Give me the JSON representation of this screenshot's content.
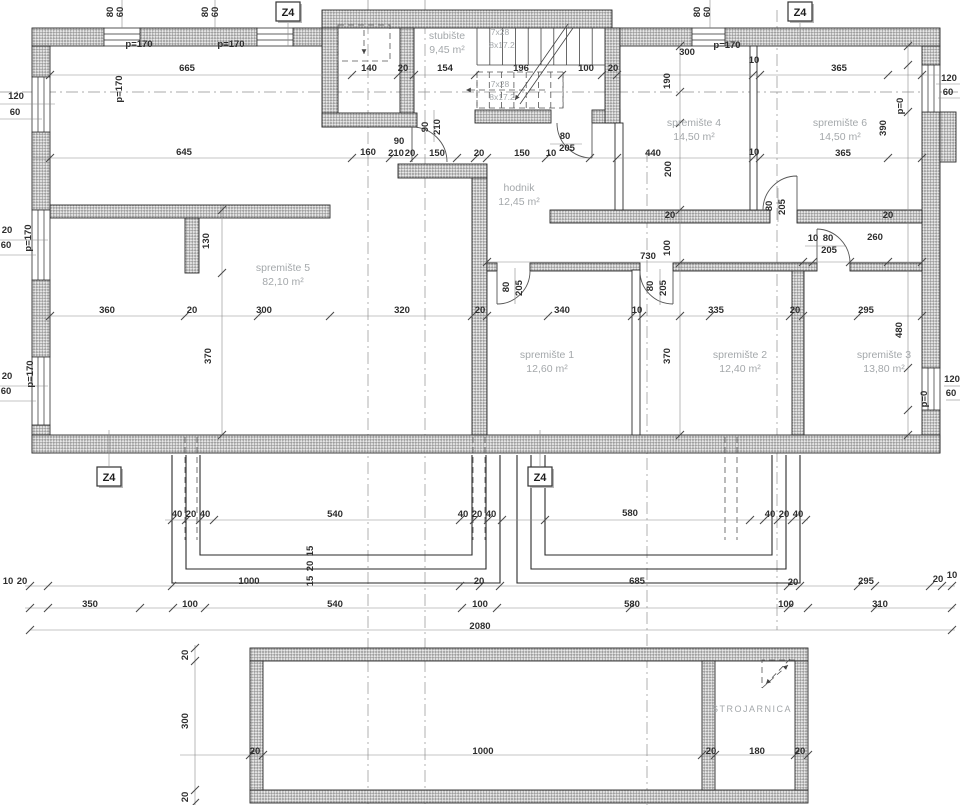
{
  "drawing": {
    "type": "basement floor plan",
    "section_marker_label": "Z4",
    "palette": {
      "line": "#2b2b2b",
      "hatch": "#a6a6a6",
      "dim_text": "#2e2e2e",
      "room_text": "#a4a8ab",
      "background": "#ffffff"
    }
  },
  "rooms": [
    {
      "name": "stubište",
      "area": "9,45 m²",
      "x": 447,
      "y": 39
    },
    {
      "name": "spremište 4",
      "area": "14,50 m²",
      "x": 694,
      "y": 126
    },
    {
      "name": "spremište 6",
      "area": "14,50 m²",
      "x": 840,
      "y": 126
    },
    {
      "name": "hodnik",
      "area": "12,45 m²",
      "x": 519,
      "y": 191
    },
    {
      "name": "spremište 5",
      "area": "82,10 m²",
      "x": 283,
      "y": 271
    },
    {
      "name": "spremište 1",
      "area": "12,60 m²",
      "x": 547,
      "y": 358
    },
    {
      "name": "spremište 2",
      "area": "12,40 m²",
      "x": 740,
      "y": 358
    },
    {
      "name": "spremište 3",
      "area": "13,80 m²",
      "x": 884,
      "y": 358
    },
    {
      "name": "STROJARNICA",
      "area": "",
      "x": 752,
      "y": 712
    }
  ],
  "stair_notes": [
    {
      "t": "7x28",
      "x": 500,
      "y": 35
    },
    {
      "t": "8x17.2",
      "x": 502,
      "y": 48
    },
    {
      "t": "7x28",
      "x": 500,
      "y": 87
    },
    {
      "t": "8x17.2",
      "x": 502,
      "y": 100
    }
  ],
  "section_markers": [
    {
      "x": 288,
      "y": 11
    },
    {
      "x": 800,
      "y": 11
    },
    {
      "x": 109,
      "y": 476
    },
    {
      "x": 540,
      "y": 476
    }
  ],
  "dims": [
    {
      "t": "80",
      "x": 113,
      "y": 12,
      "r": 1
    },
    {
      "t": "60",
      "x": 123,
      "y": 12,
      "r": 1
    },
    {
      "t": "80",
      "x": 208,
      "y": 12,
      "r": 1
    },
    {
      "t": "60",
      "x": 218,
      "y": 12,
      "r": 1
    },
    {
      "t": "80",
      "x": 700,
      "y": 12,
      "r": 1
    },
    {
      "t": "60",
      "x": 710,
      "y": 12,
      "r": 1
    },
    {
      "t": "p=170",
      "x": 139,
      "y": 47
    },
    {
      "t": "p=170",
      "x": 231,
      "y": 47
    },
    {
      "t": "p=170",
      "x": 727,
      "y": 48
    },
    {
      "t": "665",
      "x": 187,
      "y": 71
    },
    {
      "t": "140",
      "x": 369,
      "y": 71
    },
    {
      "t": "20",
      "x": 403,
      "y": 71
    },
    {
      "t": "154",
      "x": 445,
      "y": 71
    },
    {
      "t": "196",
      "x": 521,
      "y": 71
    },
    {
      "t": "100",
      "x": 586,
      "y": 71
    },
    {
      "t": "20",
      "x": 613,
      "y": 71
    },
    {
      "t": "300",
      "x": 687,
      "y": 55
    },
    {
      "t": "10",
      "x": 754,
      "y": 63
    },
    {
      "t": "365",
      "x": 839,
      "y": 71
    },
    {
      "t": "120",
      "x": 949,
      "y": 81
    },
    {
      "t": "60",
      "x": 948,
      "y": 95
    },
    {
      "t": "390",
      "x": 886,
      "y": 128,
      "r": 1
    },
    {
      "t": "p=0",
      "x": 903,
      "y": 106,
      "r": 1
    },
    {
      "t": "190",
      "x": 670,
      "y": 81,
      "r": 1
    },
    {
      "t": "120",
      "x": 16,
      "y": 99
    },
    {
      "t": "60",
      "x": 15,
      "y": 115
    },
    {
      "t": "p=170",
      "x": 122,
      "y": 89,
      "r": 1
    },
    {
      "t": "645",
      "x": 184,
      "y": 155
    },
    {
      "t": "160",
      "x": 368,
      "y": 155
    },
    {
      "t": "90",
      "x": 399,
      "y": 144
    },
    {
      "t": "210",
      "x": 396,
      "y": 156
    },
    {
      "t": "20",
      "x": 410,
      "y": 156
    },
    {
      "t": "90",
      "x": 428,
      "y": 127,
      "r": 1
    },
    {
      "t": "210",
      "x": 440,
      "y": 127,
      "r": 1
    },
    {
      "t": "150",
      "x": 437,
      "y": 156
    },
    {
      "t": "20",
      "x": 479,
      "y": 156
    },
    {
      "t": "150",
      "x": 522,
      "y": 156
    },
    {
      "t": "10",
      "x": 551,
      "y": 156
    },
    {
      "t": "80",
      "x": 565,
      "y": 139
    },
    {
      "t": "205",
      "x": 567,
      "y": 151
    },
    {
      "t": "440",
      "x": 653,
      "y": 156
    },
    {
      "t": "200",
      "x": 671,
      "y": 169,
      "r": 1
    },
    {
      "t": "10",
      "x": 754,
      "y": 155
    },
    {
      "t": "365",
      "x": 843,
      "y": 156
    },
    {
      "t": "p=170",
      "x": 31,
      "y": 238,
      "r": 1
    },
    {
      "t": "20",
      "x": 7,
      "y": 233
    },
    {
      "t": "60",
      "x": 6,
      "y": 248
    },
    {
      "t": "130",
      "x": 209,
      "y": 241,
      "r": 1
    },
    {
      "t": "20",
      "x": 670,
      "y": 218
    },
    {
      "t": "20",
      "x": 888,
      "y": 218
    },
    {
      "t": "80",
      "x": 772,
      "y": 206,
      "r": 1
    },
    {
      "t": "205",
      "x": 785,
      "y": 207,
      "r": 1
    },
    {
      "t": "730",
      "x": 648,
      "y": 259
    },
    {
      "t": "100",
      "x": 670,
      "y": 248,
      "r": 1
    },
    {
      "t": "10",
      "x": 813,
      "y": 241
    },
    {
      "t": "80",
      "x": 828,
      "y": 241
    },
    {
      "t": "205",
      "x": 829,
      "y": 253
    },
    {
      "t": "260",
      "x": 875,
      "y": 240
    },
    {
      "t": "360",
      "x": 107,
      "y": 313
    },
    {
      "t": "20",
      "x": 192,
      "y": 313
    },
    {
      "t": "300",
      "x": 264,
      "y": 313
    },
    {
      "t": "320",
      "x": 402,
      "y": 313
    },
    {
      "t": "20",
      "x": 480,
      "y": 313
    },
    {
      "t": "340",
      "x": 562,
      "y": 313
    },
    {
      "t": "10",
      "x": 637,
      "y": 313
    },
    {
      "t": "335",
      "x": 716,
      "y": 313
    },
    {
      "t": "20",
      "x": 795,
      "y": 313
    },
    {
      "t": "295",
      "x": 866,
      "y": 313
    },
    {
      "t": "370",
      "x": 211,
      "y": 356,
      "r": 1
    },
    {
      "t": "370",
      "x": 670,
      "y": 356,
      "r": 1
    },
    {
      "t": "480",
      "x": 902,
      "y": 330,
      "r": 1
    },
    {
      "t": "80",
      "x": 509,
      "y": 287,
      "r": 1
    },
    {
      "t": "205",
      "x": 522,
      "y": 288,
      "r": 1
    },
    {
      "t": "80",
      "x": 653,
      "y": 286,
      "r": 1
    },
    {
      "t": "205",
      "x": 666,
      "y": 288,
      "r": 1
    },
    {
      "t": "p=170",
      "x": 33,
      "y": 374,
      "r": 1
    },
    {
      "t": "20",
      "x": 7,
      "y": 379
    },
    {
      "t": "60",
      "x": 6,
      "y": 394
    },
    {
      "t": "120",
      "x": 952,
      "y": 382
    },
    {
      "t": "60",
      "x": 951,
      "y": 396
    },
    {
      "t": "p=0",
      "x": 927,
      "y": 399,
      "r": 1
    },
    {
      "t": "40",
      "x": 177,
      "y": 517
    },
    {
      "t": "20",
      "x": 191,
      "y": 517
    },
    {
      "t": "40",
      "x": 205,
      "y": 517
    },
    {
      "t": "540",
      "x": 335,
      "y": 517
    },
    {
      "t": "40",
      "x": 463,
      "y": 517
    },
    {
      "t": "20",
      "x": 477,
      "y": 517
    },
    {
      "t": "40",
      "x": 491,
      "y": 517
    },
    {
      "t": "580",
      "x": 630,
      "y": 516
    },
    {
      "t": "40",
      "x": 770,
      "y": 517
    },
    {
      "t": "20",
      "x": 784,
      "y": 517
    },
    {
      "t": "40",
      "x": 798,
      "y": 517
    },
    {
      "t": "15",
      "x": 313,
      "y": 551,
      "r": 1
    },
    {
      "t": "20",
      "x": 313,
      "y": 566,
      "r": 1
    },
    {
      "t": "15",
      "x": 313,
      "y": 581,
      "r": 1
    },
    {
      "t": "10",
      "x": 8,
      "y": 584
    },
    {
      "t": "20",
      "x": 22,
      "y": 584
    },
    {
      "t": "1000",
      "x": 249,
      "y": 584
    },
    {
      "t": "20",
      "x": 479,
      "y": 584
    },
    {
      "t": "685",
      "x": 637,
      "y": 584
    },
    {
      "t": "20",
      "x": 793,
      "y": 585
    },
    {
      "t": "295",
      "x": 866,
      "y": 584
    },
    {
      "t": "20",
      "x": 938,
      "y": 582
    },
    {
      "t": "10",
      "x": 952,
      "y": 578
    },
    {
      "t": "350",
      "x": 90,
      "y": 607
    },
    {
      "t": "100",
      "x": 190,
      "y": 607
    },
    {
      "t": "540",
      "x": 335,
      "y": 607
    },
    {
      "t": "100",
      "x": 480,
      "y": 607
    },
    {
      "t": "580",
      "x": 632,
      "y": 607
    },
    {
      "t": "100",
      "x": 786,
      "y": 607
    },
    {
      "t": "310",
      "x": 880,
      "y": 607
    },
    {
      "t": "2080",
      "x": 480,
      "y": 629
    },
    {
      "t": "20",
      "x": 188,
      "y": 655,
      "r": 1
    },
    {
      "t": "300",
      "x": 188,
      "y": 721,
      "r": 1
    },
    {
      "t": "20",
      "x": 188,
      "y": 797,
      "r": 1
    },
    {
      "t": "20",
      "x": 255,
      "y": 754
    },
    {
      "t": "1000",
      "x": 483,
      "y": 754
    },
    {
      "t": "20",
      "x": 711,
      "y": 754
    },
    {
      "t": "180",
      "x": 757,
      "y": 754
    },
    {
      "t": "20",
      "x": 800,
      "y": 754
    }
  ]
}
